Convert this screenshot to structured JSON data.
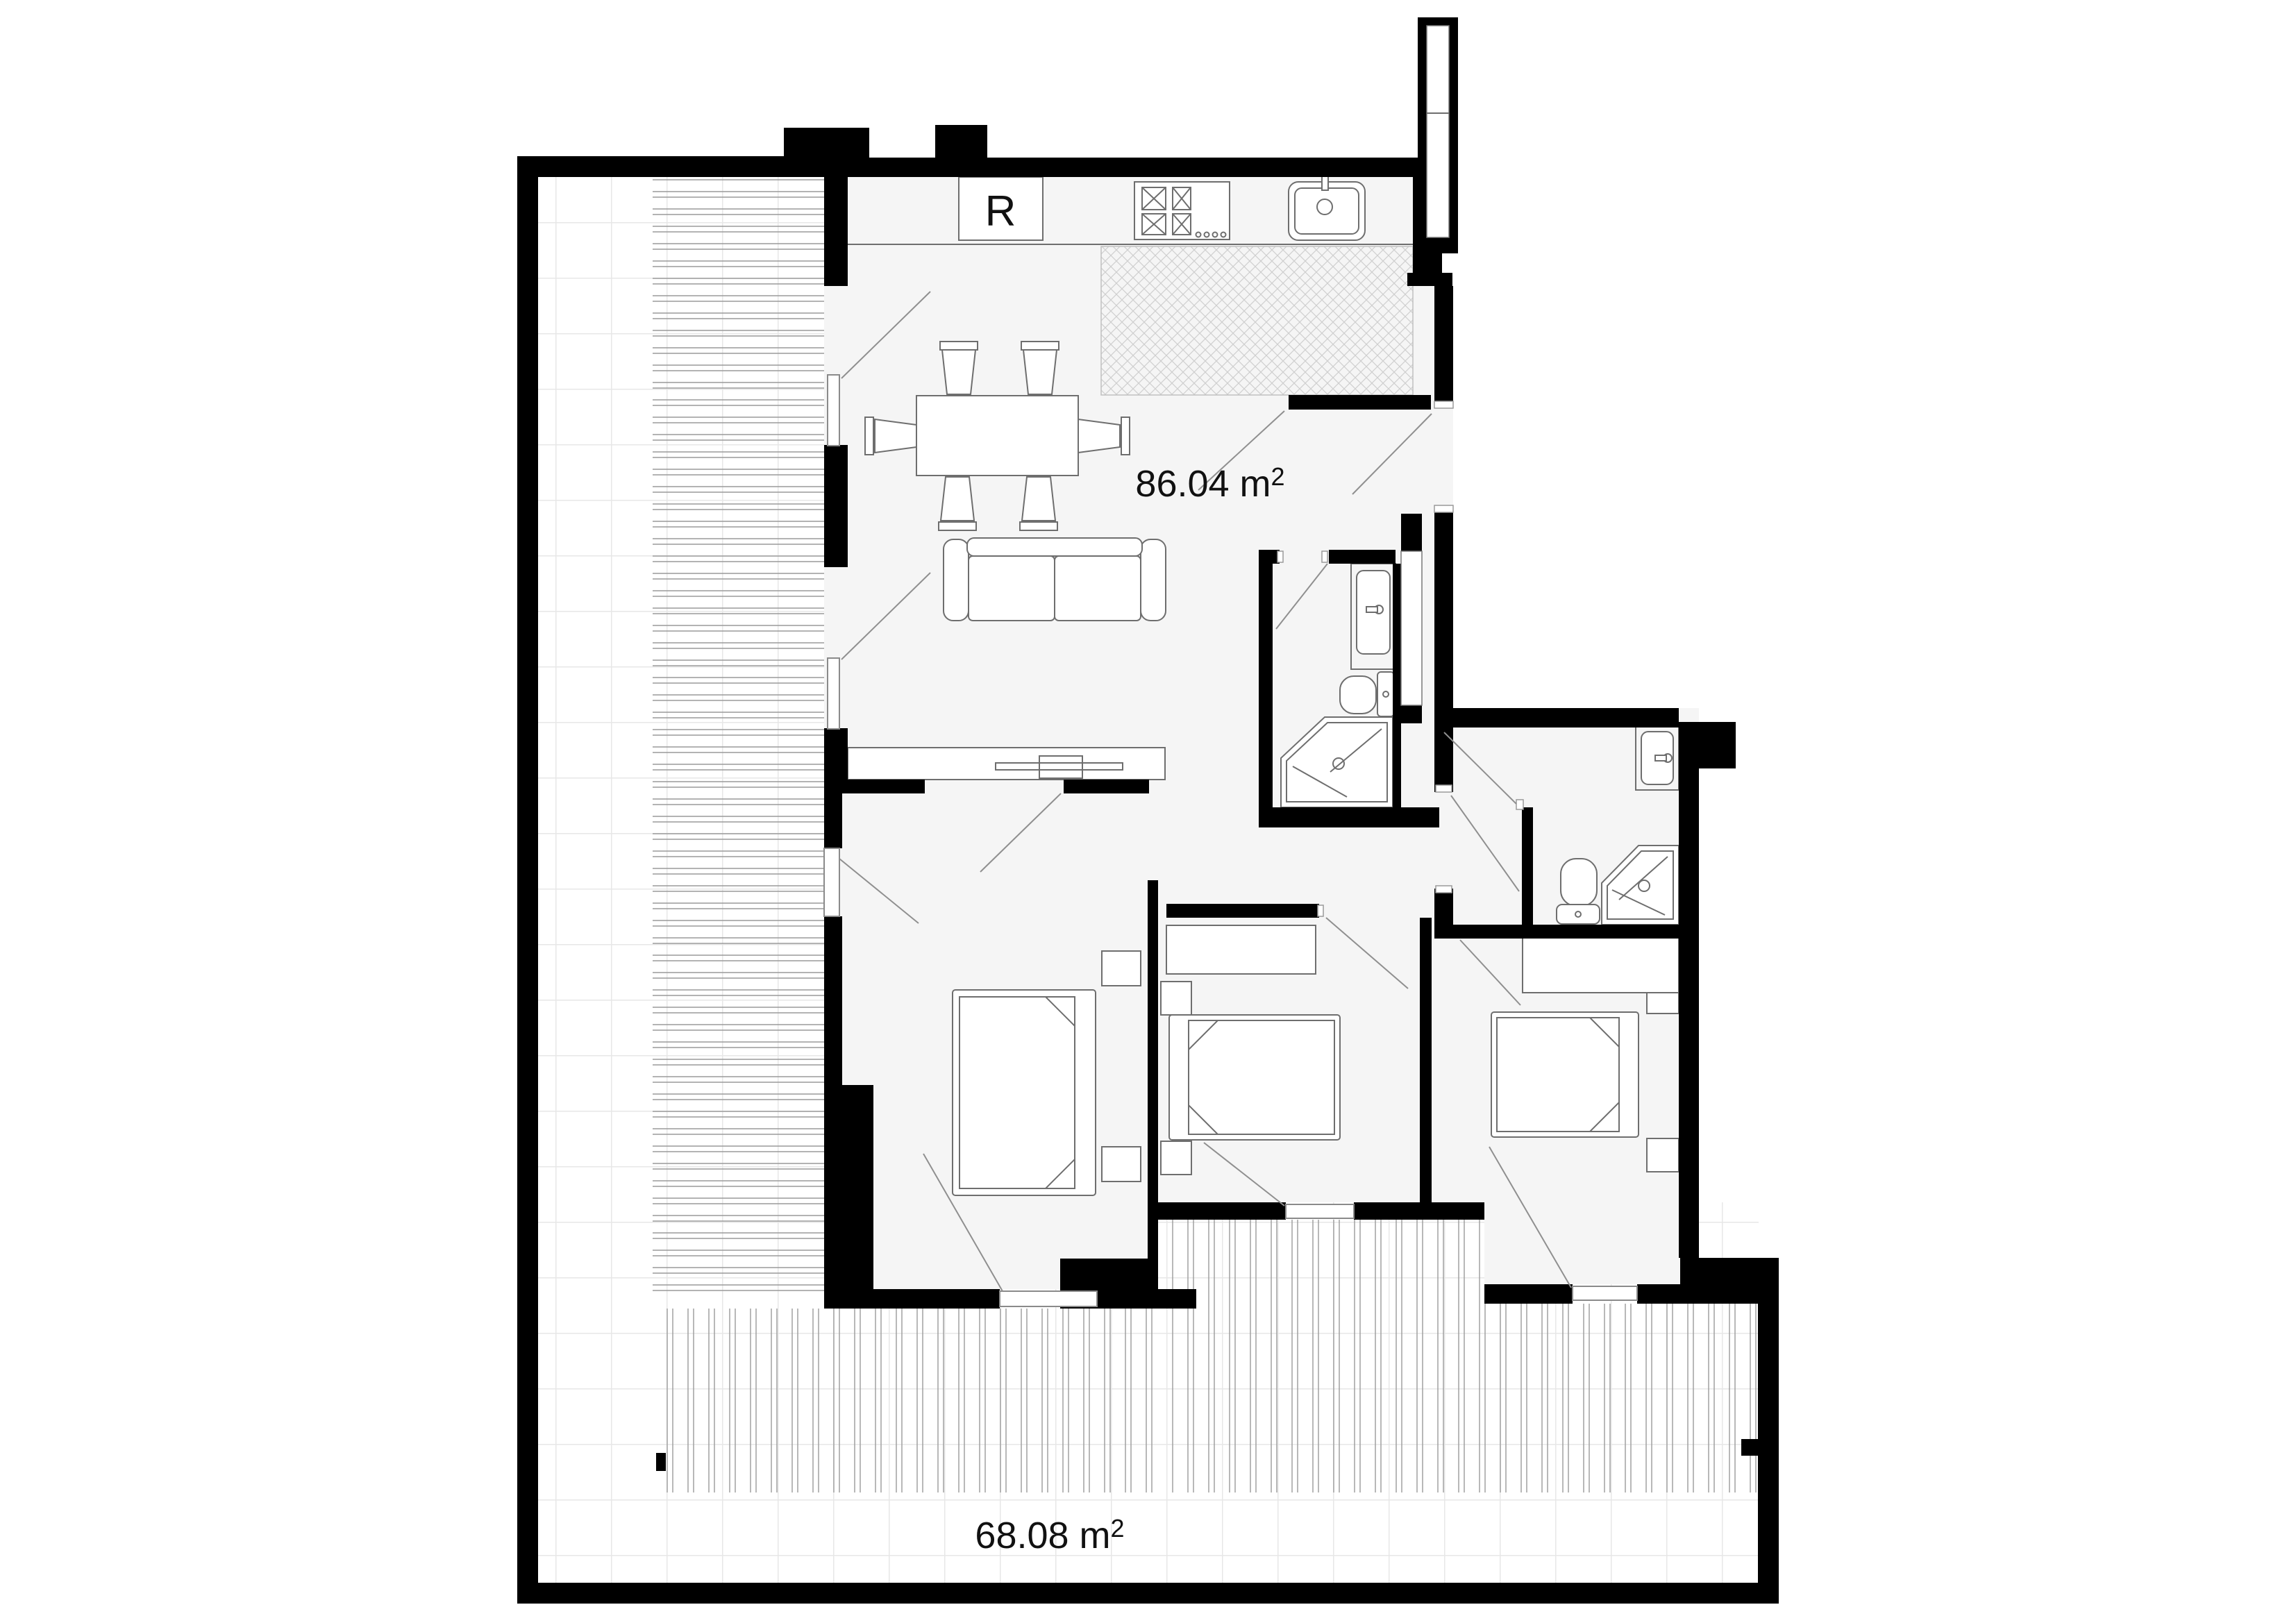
{
  "document": {
    "type": "architectural-floor-plan",
    "units": "m2"
  },
  "labels": {
    "living_area": {
      "value": "86.04 m",
      "sup": "2"
    },
    "terrace_area": {
      "value": "68.08 m",
      "sup": "2"
    },
    "refrigerator": "R"
  },
  "colors": {
    "wall": "#000000",
    "floor_interior": "#f5f5f5",
    "background": "#ffffff",
    "fixture_line": "#6e6e6e",
    "swing_line": "#8f8f8f",
    "grid_line": "#e7e7e7",
    "hatch_line": "#cfcfcf",
    "deck_line": "#999999",
    "label_text": "#111111"
  },
  "icons": [
    "refrigerator-icon",
    "stove-icon",
    "kitchen-sink-icon",
    "dining-table-icon",
    "chair-icon",
    "sofa-icon",
    "tv-console-icon",
    "bed-icon",
    "nightstand-icon",
    "wardrobe-icon",
    "toilet-icon",
    "shower-icon",
    "vanity-sink-icon",
    "door-swing-icon",
    "window-icon",
    "deck-boards-icon",
    "crosshatch-icon",
    "duct-shaft-icon"
  ],
  "counts": {
    "bedrooms": 3,
    "bathrooms": 2,
    "dining_chairs": 6
  }
}
